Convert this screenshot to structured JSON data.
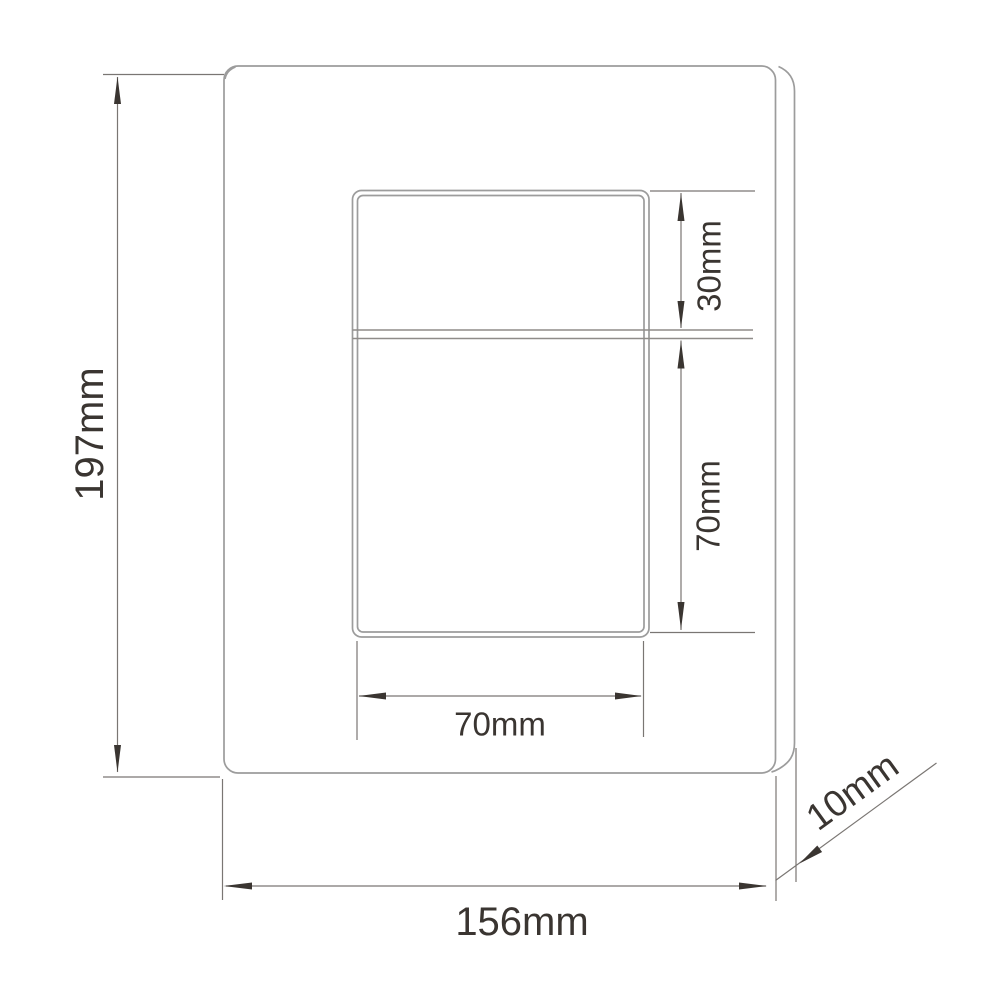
{
  "diagram": {
    "type": "technical-drawing",
    "subject": "wall plate front view with dimensions",
    "unit": "mm",
    "background_color": "#ffffff",
    "outline_color": "#9c9c9c",
    "dim_line_color": "#7a7673",
    "text_color": "#3a3531",
    "arrow_color": "#3a3531",
    "dimensions": {
      "plate_height": {
        "label": "197mm",
        "value": 197,
        "unit": "mm"
      },
      "plate_width": {
        "label": "156mm",
        "value": 156,
        "unit": "mm"
      },
      "plate_thickness": {
        "label": "10mm",
        "value": 10,
        "unit": "mm"
      },
      "opening_top_section_height": {
        "label": "30mm",
        "value": 30,
        "unit": "mm"
      },
      "opening_bottom_section_height": {
        "label": "70mm",
        "value": 70,
        "unit": "mm"
      },
      "opening_width": {
        "label": "70mm",
        "value": 70,
        "unit": "mm"
      }
    }
  }
}
